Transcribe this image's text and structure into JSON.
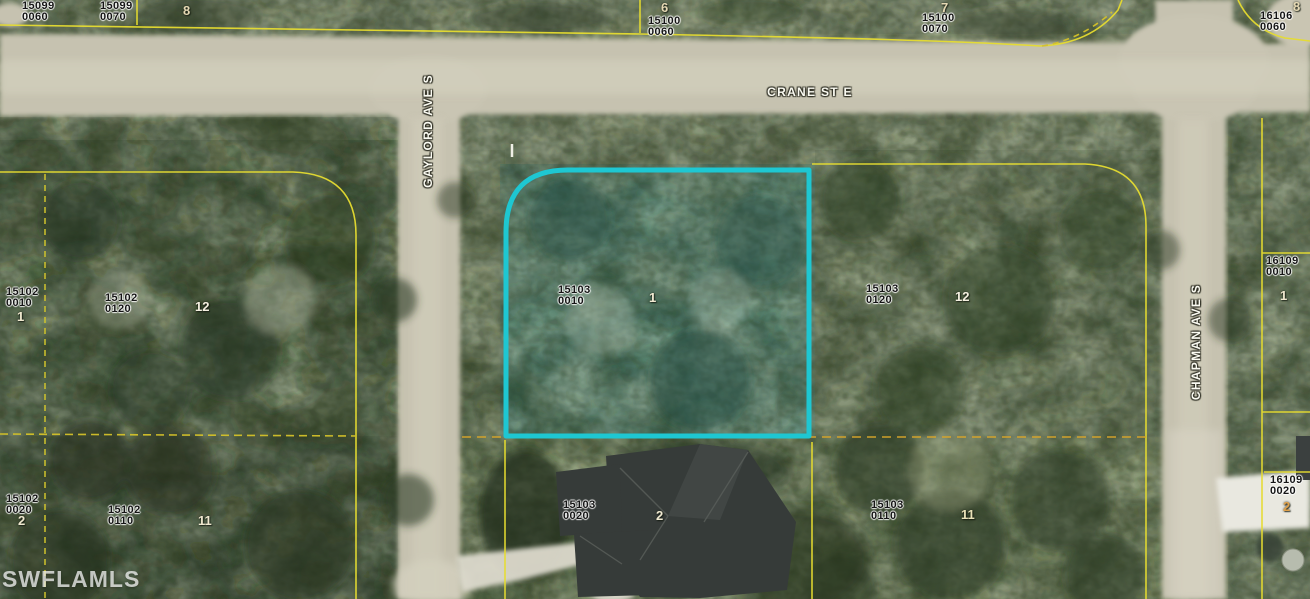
{
  "map": {
    "watermark": "SWFLAMLS",
    "highlighted_parcel": {
      "id": "15103",
      "sub": "0010",
      "lot": "1",
      "outline_color": "#1ec7d2"
    },
    "boundary_color": "#e6dc30",
    "dashed_boundary_color": "#d9a62b",
    "streets": [
      {
        "name": "CRANE ST E",
        "cx": 810,
        "cy": 92,
        "rotate": 0
      },
      {
        "name": "GAYLORD AVE S",
        "cx": 428,
        "cy": 131,
        "rotate": -90
      },
      {
        "name": "CHAPMAN AVE S",
        "cx": 1196,
        "cy": 342,
        "rotate": -90
      }
    ],
    "parcels": [
      {
        "id": "15099",
        "sub": "0060",
        "x": 22,
        "y": 1
      },
      {
        "id": "15099",
        "sub": "0070",
        "x": 100,
        "y": 1
      },
      {
        "id": "15100",
        "sub": "0060",
        "x": 648,
        "y": 16
      },
      {
        "id": "15100",
        "sub": "0070",
        "x": 922,
        "y": 13
      },
      {
        "id": "16106",
        "sub": "0060",
        "x": 1260,
        "y": 11
      },
      {
        "id": "15102",
        "sub": "0010",
        "x": 6,
        "y": 287
      },
      {
        "id": "15102",
        "sub": "0120",
        "x": 105,
        "y": 293
      },
      {
        "id": "15103",
        "sub": "0010",
        "x": 558,
        "y": 285
      },
      {
        "id": "15103",
        "sub": "0120",
        "x": 866,
        "y": 284
      },
      {
        "id": "16109",
        "sub": "0010",
        "x": 1266,
        "y": 256
      },
      {
        "id": "15102",
        "sub": "0020",
        "x": 6,
        "y": 494
      },
      {
        "id": "15102",
        "sub": "0110",
        "x": 108,
        "y": 505
      },
      {
        "id": "15103",
        "sub": "0020",
        "x": 563,
        "y": 500
      },
      {
        "id": "15103",
        "sub": "0110",
        "x": 871,
        "y": 500
      },
      {
        "id": "16109",
        "sub": "0020",
        "x": 1270,
        "y": 475
      }
    ],
    "lot_numbers": [
      {
        "n": "8",
        "x": 183,
        "y": 4,
        "color": "#e6d9b4"
      },
      {
        "n": "6",
        "x": 661,
        "y": 1,
        "color": "#e6d9b4"
      },
      {
        "n": "7",
        "x": 941,
        "y": 1,
        "color": "#e6d9b4"
      },
      {
        "n": "8",
        "x": 1293,
        "y": 0,
        "color": "#e6d9b4"
      },
      {
        "n": "1",
        "x": 649,
        "y": 291,
        "color": "#f1ead2"
      },
      {
        "n": "12",
        "x": 955,
        "y": 290,
        "color": "#f4efe0"
      },
      {
        "n": "1",
        "x": 17,
        "y": 310,
        "color": "#efe8cf"
      },
      {
        "n": "12",
        "x": 195,
        "y": 300,
        "color": "#f4efe0"
      },
      {
        "n": "1",
        "x": 1280,
        "y": 289,
        "color": "#efe8cf"
      },
      {
        "n": "2",
        "x": 1283,
        "y": 500,
        "color": "#dfa04a"
      },
      {
        "n": "2",
        "x": 656,
        "y": 509,
        "color": "#f1ead2"
      },
      {
        "n": "11",
        "x": 961,
        "y": 508,
        "color": "#e9e2b8"
      },
      {
        "n": "2",
        "x": 18,
        "y": 514,
        "color": "#efe8cf"
      },
      {
        "n": "11",
        "x": 198,
        "y": 514,
        "color": "#efe8cf"
      }
    ]
  }
}
